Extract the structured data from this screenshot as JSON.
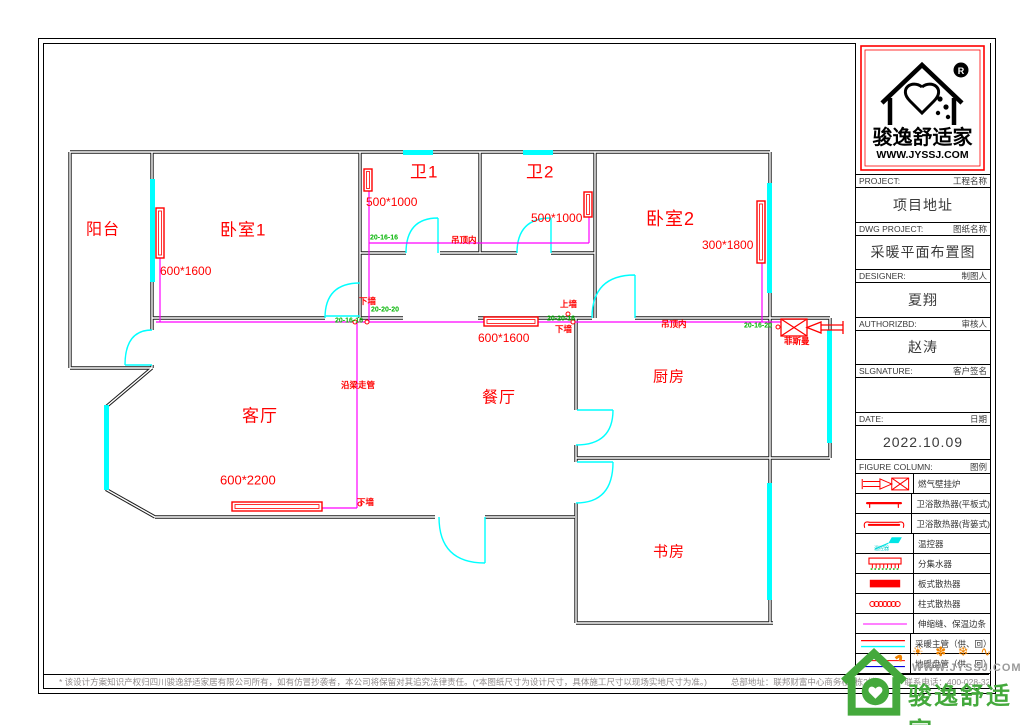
{
  "title_block": {
    "logo": {
      "brand": "骏逸舒适家",
      "site": "WWW.JYSSJ.COM",
      "reg": "R"
    },
    "rows": [
      {
        "en": "PROJECT:",
        "cn": "工程名称",
        "value": "项目地址"
      },
      {
        "en": "DWG PROJECT:",
        "cn": "图纸名称",
        "value": "采暖平面布置图"
      },
      {
        "en": "DESIGNER:",
        "cn": "制图人",
        "value": "夏翔"
      },
      {
        "en": "AUTHORIZBD:",
        "cn": "审核人",
        "value": "赵涛"
      },
      {
        "en": "SLGNATURE:",
        "cn": "客户签名",
        "value": ""
      },
      {
        "en": "DATE:",
        "cn": "日期",
        "value": "2022.10.09"
      }
    ],
    "legend_header": {
      "en": "FIGURE COLUMN:",
      "cn": "图例"
    },
    "legend": [
      {
        "icon": "boiler",
        "label": "燃气壁挂炉",
        "tag": ""
      },
      {
        "icon": "flat-rad",
        "label": "卫浴散热器(平板式)",
        "tag": ""
      },
      {
        "icon": "basket-rad",
        "label": "卫浴散热器(背篓式)",
        "tag": ""
      },
      {
        "icon": "thermostat",
        "label": "温控器",
        "tag": "温控器"
      },
      {
        "icon": "manifold",
        "label": "分集水器",
        "tag": ""
      },
      {
        "icon": "panel-rad",
        "label": "板式散热器",
        "tag": ""
      },
      {
        "icon": "column-rad",
        "label": "柱式散热器",
        "tag": ""
      },
      {
        "icon": "joint",
        "label": "伸缩缝、保温边条",
        "tag": ""
      },
      {
        "icon": "main-pipe",
        "label": "采暖主管（供、回）",
        "tag": ""
      },
      {
        "icon": "floor-pipe",
        "label": "地暖盘管（供、回）",
        "tag": ""
      }
    ]
  },
  "plan": {
    "rooms": [
      {
        "t": "阳台",
        "x": 40,
        "y": 178,
        "fs": 16
      },
      {
        "t": "卧室1",
        "x": 174,
        "y": 177,
        "fs": 17
      },
      {
        "t": "卫1",
        "x": 364,
        "y": 119,
        "fs": 17
      },
      {
        "t": "卫2",
        "x": 480,
        "y": 119,
        "fs": 17
      },
      {
        "t": "卧室2",
        "x": 600,
        "y": 166,
        "fs": 18
      },
      {
        "t": "客厅",
        "x": 196,
        "y": 363,
        "fs": 17
      },
      {
        "t": "餐厅",
        "x": 436,
        "y": 346,
        "fs": 16
      },
      {
        "t": "厨房",
        "x": 607,
        "y": 325,
        "fs": 15
      },
      {
        "t": "书房",
        "x": 607,
        "y": 500,
        "fs": 15
      }
    ],
    "dims": [
      {
        "t": "600*1600",
        "x": 114,
        "y": 220,
        "fs": 12
      },
      {
        "t": "500*1000",
        "x": 320,
        "y": 151,
        "fs": 12
      },
      {
        "t": "500*1000",
        "x": 485,
        "y": 167,
        "fs": 12
      },
      {
        "t": "300*1800",
        "x": 656,
        "y": 194,
        "fs": 12
      },
      {
        "t": "600*1600",
        "x": 432,
        "y": 287,
        "fs": 12
      },
      {
        "t": "600*2200",
        "x": 174,
        "y": 429,
        "fs": 13
      }
    ],
    "notes": [
      {
        "t": "下墙",
        "x": 313,
        "y": 252,
        "fs": 8.5
      },
      {
        "t": "上墙",
        "x": 514,
        "y": 255,
        "fs": 8.5
      },
      {
        "t": "下墙",
        "x": 509,
        "y": 280,
        "fs": 8.5
      },
      {
        "t": "吊顶内",
        "x": 405,
        "y": 191,
        "fs": 8.5
      },
      {
        "t": "吊顶内",
        "x": 615,
        "y": 275,
        "fs": 8.5
      },
      {
        "t": "菲斯曼",
        "x": 738,
        "y": 292,
        "fs": 8.5
      },
      {
        "t": "沿梁走管",
        "x": 295,
        "y": 336,
        "fs": 8.5
      },
      {
        "t": "下墙",
        "x": 311,
        "y": 453,
        "fs": 8.5
      }
    ],
    "codes": [
      {
        "t": "20-16-16",
        "x": 289,
        "y": 272,
        "fs": 7
      },
      {
        "t": "20-20-20",
        "x": 325,
        "y": 261,
        "fs": 7
      },
      {
        "t": "20-16-16",
        "x": 324,
        "y": 189,
        "fs": 7
      },
      {
        "t": "20-20-16",
        "x": 501,
        "y": 270,
        "fs": 7
      },
      {
        "t": "20-16-20",
        "x": 698,
        "y": 277,
        "fs": 7
      }
    ]
  },
  "footer": {
    "disclaimer": "* 该设计方案知识产权归四川骏逸舒适家居有限公司所有，如有仿冒抄袭者，本公司将保留对其追究法律责任。(*本图纸尺寸为设计尺寸，具体施工尺寸以现场实地尺寸为准。)",
    "address": "总部地址：联邦财富中心商务楼2栋2楼",
    "phone": "联系电话：400-028-3206"
  },
  "watermark": {
    "icons": "☀ ✽ ❄ ∿",
    "site": "WWW.JYSSJ.COM",
    "brand": "骏逸舒适家"
  },
  "colors": {
    "cad_red": "#ff0000",
    "pipe_magenta": "#ff00ff",
    "window_cyan": "#00ffff",
    "code_green": "#00b400",
    "wall_black": "#1c1c1c",
    "brand_green": "#44a93c",
    "brand_orange": "#f08300"
  }
}
